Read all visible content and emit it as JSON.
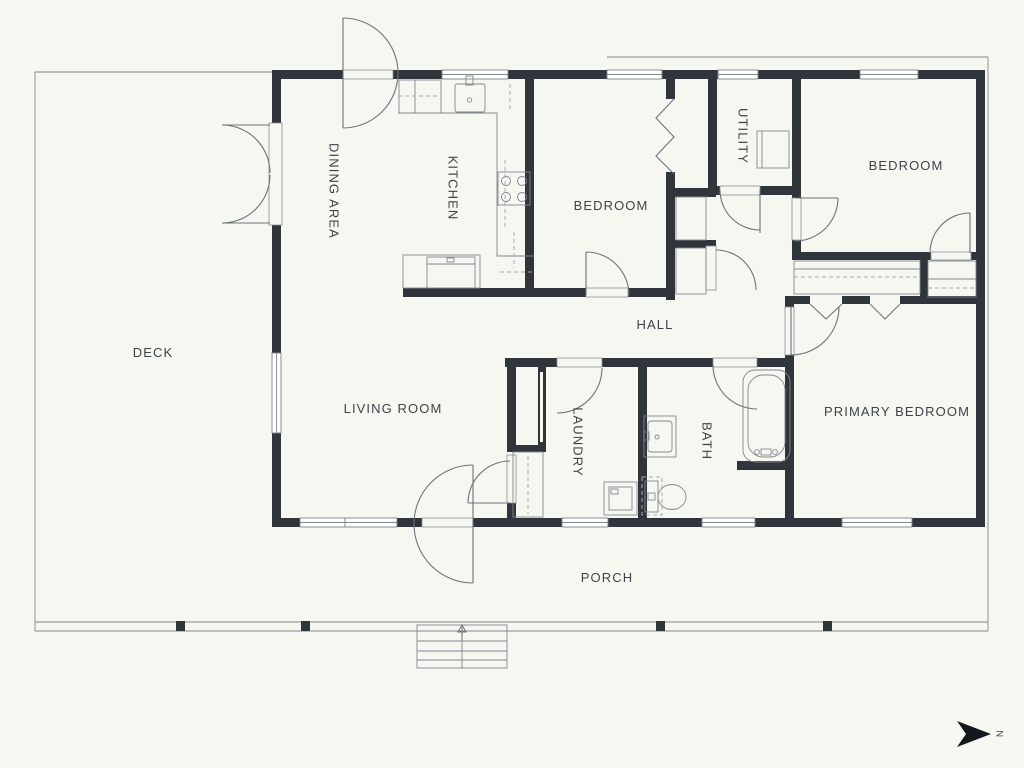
{
  "title": "Single storey house floor plan",
  "rooms": [
    {
      "id": "deck",
      "label": "DECK",
      "orientation": "horizontal"
    },
    {
      "id": "dining-area",
      "label": "DINING AREA",
      "orientation": "vertical"
    },
    {
      "id": "kitchen",
      "label": "KITCHEN",
      "orientation": "vertical"
    },
    {
      "id": "bedroom-middle",
      "label": "BEDROOM",
      "orientation": "horizontal"
    },
    {
      "id": "utility",
      "label": "UTILITY",
      "orientation": "vertical"
    },
    {
      "id": "bedroom-right",
      "label": "BEDROOM",
      "orientation": "horizontal"
    },
    {
      "id": "hall",
      "label": "HALL",
      "orientation": "horizontal"
    },
    {
      "id": "living-room",
      "label": "LIVING ROOM",
      "orientation": "horizontal"
    },
    {
      "id": "laundry",
      "label": "LAUNDRY",
      "orientation": "vertical"
    },
    {
      "id": "bath",
      "label": "BATH",
      "orientation": "vertical"
    },
    {
      "id": "primary-bedroom",
      "label": "PRIMARY BEDROOM",
      "orientation": "horizontal"
    },
    {
      "id": "porch",
      "label": "PORCH",
      "orientation": "horizontal"
    }
  ],
  "compass": {
    "label": "N",
    "direction": "right"
  },
  "colors": {
    "background": "#f7f7f2",
    "wall": "#30353b",
    "line": "#6e737b",
    "text": "#3e434a",
    "compass": "#14181c"
  }
}
